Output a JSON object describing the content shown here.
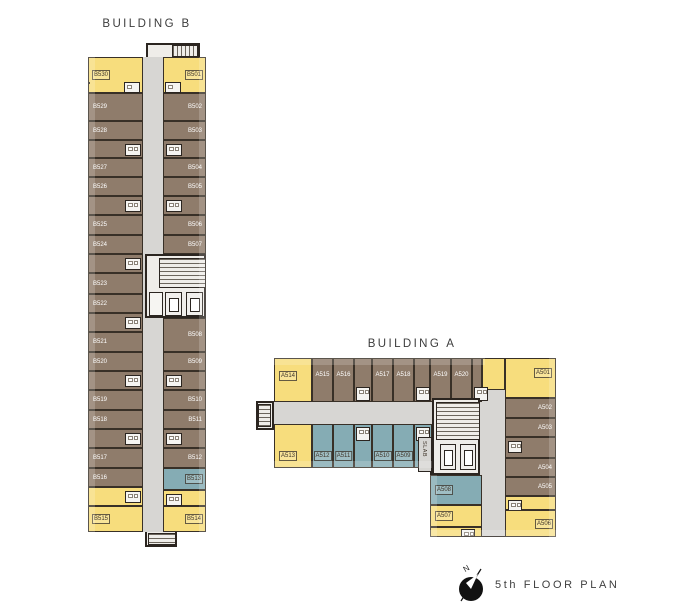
{
  "footer": {
    "plan_label": "5th FLOOR PLAN",
    "compass_n": "N"
  },
  "colors": {
    "yellow": "#F7DD7D",
    "brown": "#8F7C6B",
    "blue": "#85ACB4",
    "corridor": "#D7D6D3",
    "core": "#EFEDE9",
    "wall": "#2B2520",
    "fixture_white": "#F5F4F1"
  },
  "buildings": {
    "b": {
      "title": "BUILDING B",
      "left_units": [
        {
          "label": "B530",
          "color": "yellow"
        },
        {
          "label": "B529",
          "color": "brown"
        },
        {
          "label": "B528",
          "color": "brown"
        },
        {
          "label": "B527",
          "color": "brown"
        },
        {
          "label": "B526",
          "color": "brown"
        },
        {
          "label": "B525",
          "color": "brown"
        },
        {
          "label": "B524",
          "color": "brown"
        },
        {
          "label": "B523",
          "color": "brown"
        },
        {
          "label": "B522",
          "color": "brown"
        },
        {
          "label": "B521",
          "color": "brown"
        },
        {
          "label": "B520",
          "color": "brown"
        },
        {
          "label": "B519",
          "color": "brown"
        },
        {
          "label": "B518",
          "color": "brown"
        },
        {
          "label": "B517",
          "color": "brown"
        },
        {
          "label": "B516",
          "color": "brown"
        },
        {
          "label": "B515",
          "color": "yellow"
        }
      ],
      "right_units": [
        {
          "label": "B501",
          "color": "yellow"
        },
        {
          "label": "B502",
          "color": "brown"
        },
        {
          "label": "B503",
          "color": "brown"
        },
        {
          "label": "B504",
          "color": "brown"
        },
        {
          "label": "B505",
          "color": "brown"
        },
        {
          "label": "B506",
          "color": "brown"
        },
        {
          "label": "B507",
          "color": "brown"
        },
        {
          "label": "B508",
          "color": "brown"
        },
        {
          "label": "B509",
          "color": "brown"
        },
        {
          "label": "B510",
          "color": "brown"
        },
        {
          "label": "B511",
          "color": "brown"
        },
        {
          "label": "B512",
          "color": "brown"
        },
        {
          "label": "B513",
          "color": "blue"
        },
        {
          "label": "B514",
          "color": "yellow"
        }
      ]
    },
    "a": {
      "title": "BUILDING A",
      "top_row": [
        {
          "label": "A514",
          "color": "yellow"
        },
        {
          "label": "A515",
          "color": "brown"
        },
        {
          "label": "A516",
          "color": "brown"
        },
        {
          "label": "A517",
          "color": "brown"
        },
        {
          "label": "A518",
          "color": "brown"
        },
        {
          "label": "A519",
          "color": "brown"
        },
        {
          "label": "A520",
          "color": "brown"
        }
      ],
      "bottom_row": [
        {
          "label": "A513",
          "color": "yellow"
        },
        {
          "label": "A512",
          "color": "blue"
        },
        {
          "label": "A511",
          "color": "blue"
        },
        {
          "label": "A510",
          "color": "blue"
        },
        {
          "label": "A509",
          "color": "blue"
        }
      ],
      "right_column": [
        {
          "label": "A501",
          "color": "yellow"
        },
        {
          "label": "A502",
          "color": "brown"
        },
        {
          "label": "A503",
          "color": "brown"
        },
        {
          "label": "A504",
          "color": "brown"
        },
        {
          "label": "A505",
          "color": "brown"
        },
        {
          "label": "A506",
          "color": "yellow"
        }
      ],
      "left_column": [
        {
          "label": "A508",
          "color": "blue"
        },
        {
          "label": "A507",
          "color": "yellow"
        }
      ],
      "slab_label": "SLAB"
    }
  }
}
